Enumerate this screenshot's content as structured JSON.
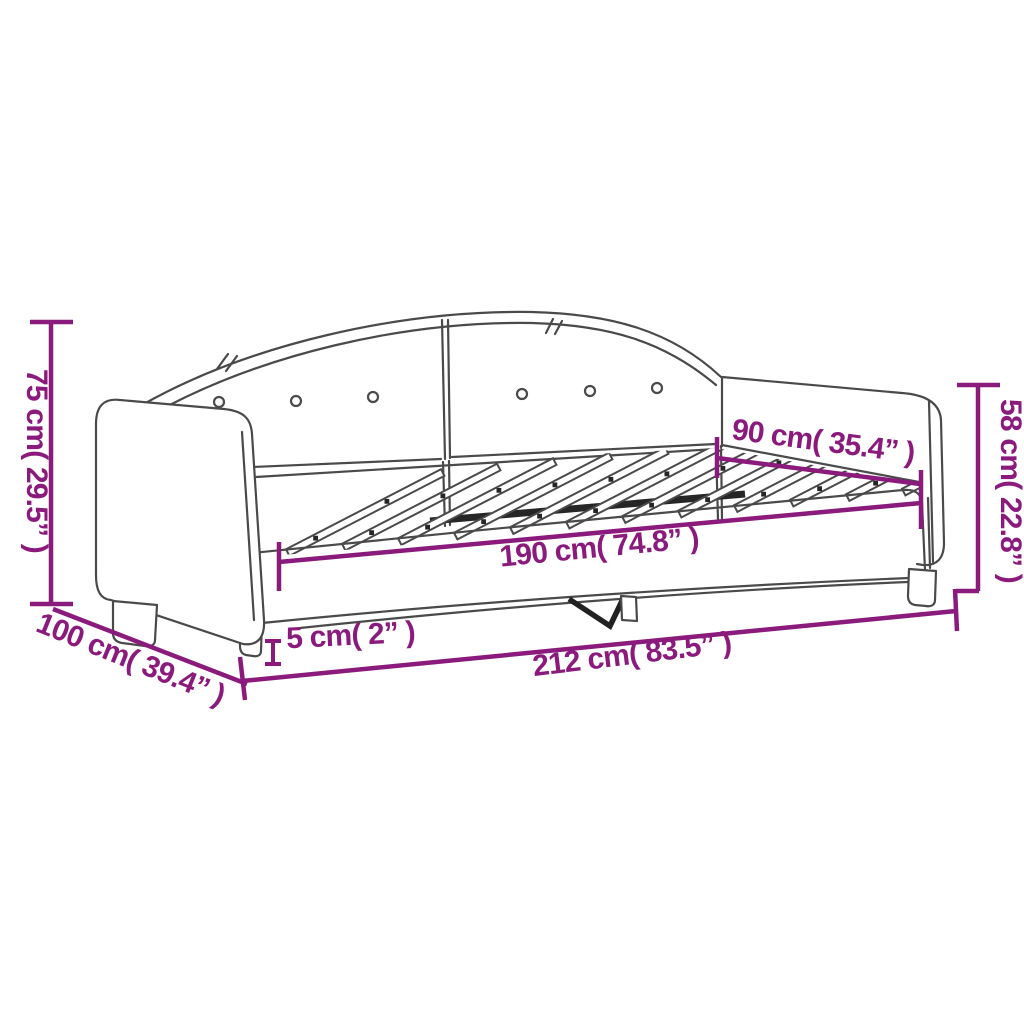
{
  "diagram": {
    "description": "Line drawing of an upholstered daybed with arched button-tufted backrest, two armrests, slatted bed base and legs, annotated with product dimensions",
    "style": {
      "dimension_color": "#8B1A7D",
      "outline_color": "#4a4a4a",
      "background_color": "#ffffff"
    },
    "dimensions": {
      "overall_height": "75 cm( 29.5” )",
      "overall_depth": "100 cm( 39.4” )",
      "overall_length": "212 cm( 83.5” )",
      "leg_height": "5 cm( 2” )",
      "sleeping_length": "190 cm( 74.8” )",
      "sleeping_width": "90 cm( 35.4” )",
      "armrest_height": "58 cm( 22.8” )"
    }
  }
}
